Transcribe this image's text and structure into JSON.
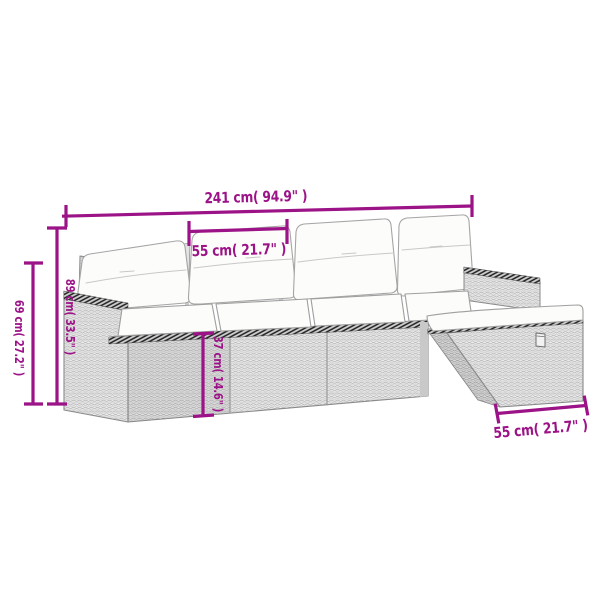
{
  "page": {
    "background": "#ffffff"
  },
  "diagram": {
    "alt": "Line drawing of a 5-piece poly rattan lounge set: 4-seat sofa with back pillows, left armrest, right armrest and a footstool/ottoman with cushion, annotated with dimension lines",
    "accent_color": "#9c1287",
    "drawing_colors": {
      "outline": "#8a8a8a",
      "wicker_light": "#ececec",
      "wicker_dark": "#dcdcdc",
      "cushion_white": "#fcfcfa",
      "hatch_dark": "#1f1f1f"
    },
    "dimensions": [
      {
        "id": "overall-width",
        "label": "241 cm( 94.9\" )",
        "cm": 241,
        "inches": 94.9,
        "orientation": "horizontal"
      },
      {
        "id": "seat-width",
        "label": "55 cm( 21.7\" )",
        "cm": 55,
        "inches": 21.7,
        "orientation": "horizontal"
      },
      {
        "id": "back-height",
        "label": "89 cm( 33.5\" )",
        "cm": 89,
        "inches": 33.5,
        "orientation": "vertical"
      },
      {
        "id": "arm-height",
        "label": "69 cm( 27.2\" )",
        "cm": 69,
        "inches": 27.2,
        "orientation": "vertical"
      },
      {
        "id": "seat-height",
        "label": "37 cm( 14.6\" )",
        "cm": 37,
        "inches": 14.6,
        "orientation": "vertical"
      },
      {
        "id": "ottoman-width",
        "label": "55 cm( 21.7\" )",
        "cm": 55,
        "inches": 21.7,
        "orientation": "horizontal"
      }
    ]
  }
}
